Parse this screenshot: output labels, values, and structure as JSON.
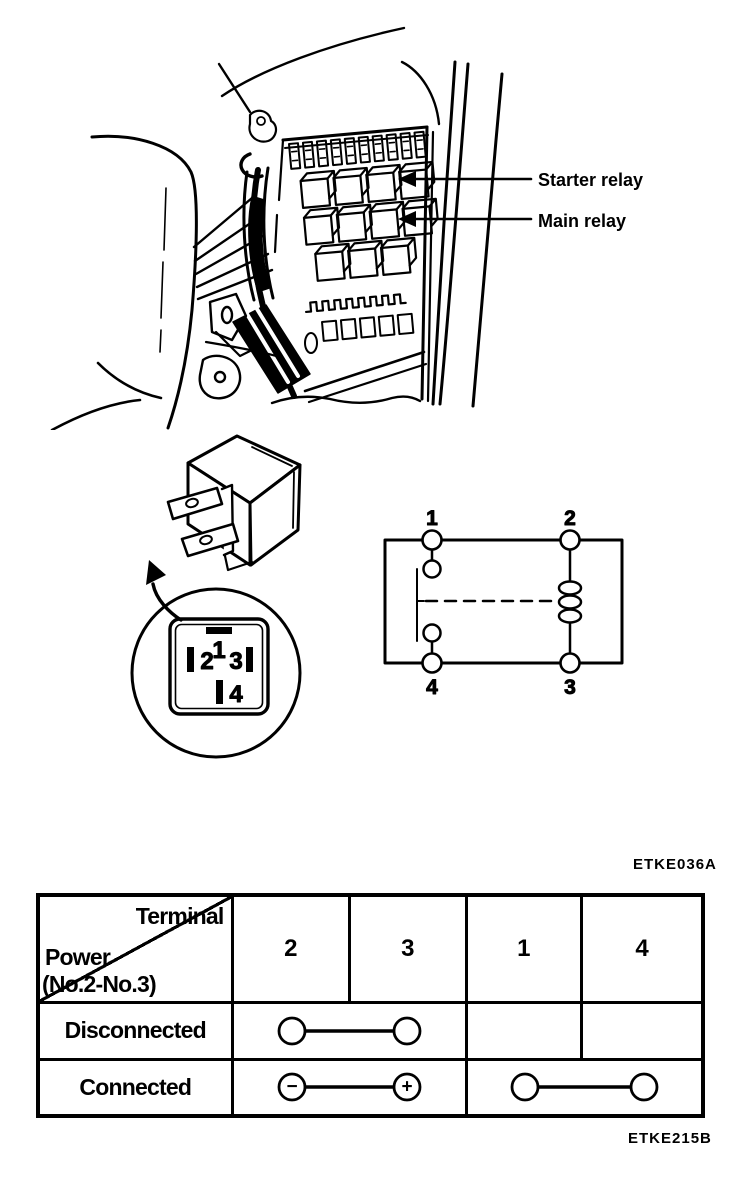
{
  "figure_top": {
    "labels": [
      {
        "text": "Starter relay"
      },
      {
        "text": "Main relay"
      }
    ]
  },
  "figure_pin_layout": {
    "pins": {
      "p1": "1",
      "p2": "2",
      "p3": "3",
      "p4": "4"
    }
  },
  "figure_schematic": {
    "terminals": {
      "top_left": "1",
      "top_right": "2",
      "bottom_left": "4",
      "bottom_right": "3"
    }
  },
  "codes": {
    "figure_code_top": "ETKE036A",
    "figure_code_bottom": "ETKE215B"
  },
  "table": {
    "header": {
      "corner_top": "Terminal",
      "corner_bottom_line1": "Power",
      "corner_bottom_line2": "(No.2-No.3)",
      "columns": [
        "2",
        "3",
        "1",
        "4"
      ]
    },
    "rows": [
      {
        "label": "Disconnected",
        "connections": [
          {
            "from": "2",
            "to": "3",
            "type": "plain"
          }
        ]
      },
      {
        "label": "Connected",
        "connections": [
          {
            "from": "2",
            "to": "3",
            "type": "polarity",
            "from_symbol": "−",
            "to_symbol": "+"
          },
          {
            "from": "1",
            "to": "4",
            "type": "plain"
          }
        ]
      }
    ]
  },
  "colors": {
    "ink": "#000000",
    "paper": "#ffffff"
  }
}
